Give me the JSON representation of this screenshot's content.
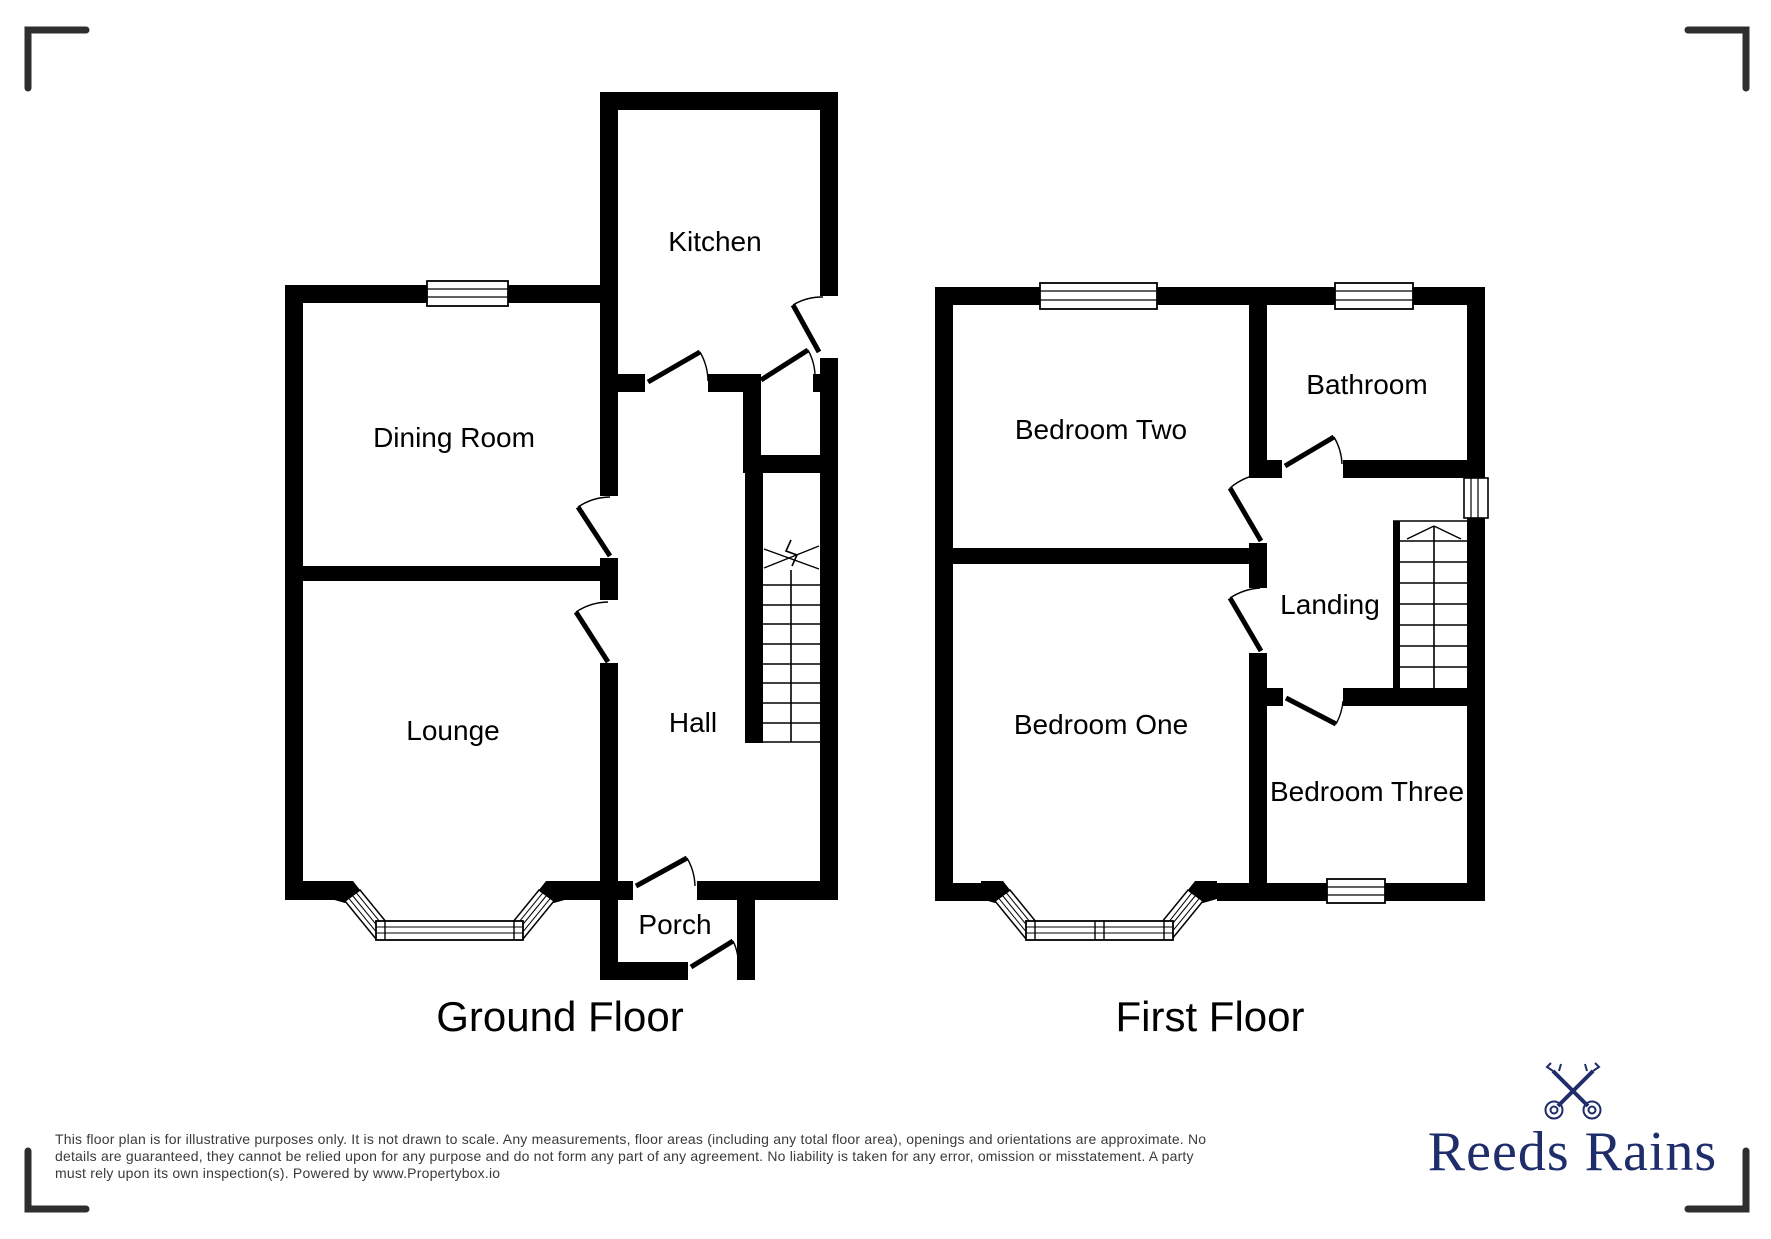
{
  "ground_floor": {
    "title": "Ground Floor",
    "rooms": {
      "kitchen": "Kitchen",
      "dining_room": "Dining Room",
      "lounge": "Lounge",
      "hall": "Hall",
      "porch": "Porch"
    }
  },
  "first_floor": {
    "title": "First Floor",
    "rooms": {
      "bedroom_two": "Bedroom Two",
      "bathroom": "Bathroom",
      "bedroom_one": "Bedroom One",
      "landing": "Landing",
      "bedroom_three": "Bedroom Three"
    }
  },
  "footer": {
    "disclaimer_lines": [
      "This floor plan is for illustrative purposes only. It is not drawn to scale. Any measurements, floor areas (including any total floor area), openings and orientations are approximate. No",
      "details are guaranteed, they cannot be relied upon for any purpose and do not form any part of any agreement. No liability is taken for any error, omission or misstatement. A party",
      "must rely upon its own inspection(s). Powered by www.Propertybox.io"
    ],
    "brand_name": "Reeds Rains"
  },
  "colors": {
    "wall": "#000000",
    "room_text": "#000000",
    "disclaimer_text": "#3a3a3a",
    "brand_navy": "#1f2d6b",
    "crop_mark": "#2e2e2e"
  },
  "icons": {
    "brand_logo": "crossed-keys-icon"
  }
}
